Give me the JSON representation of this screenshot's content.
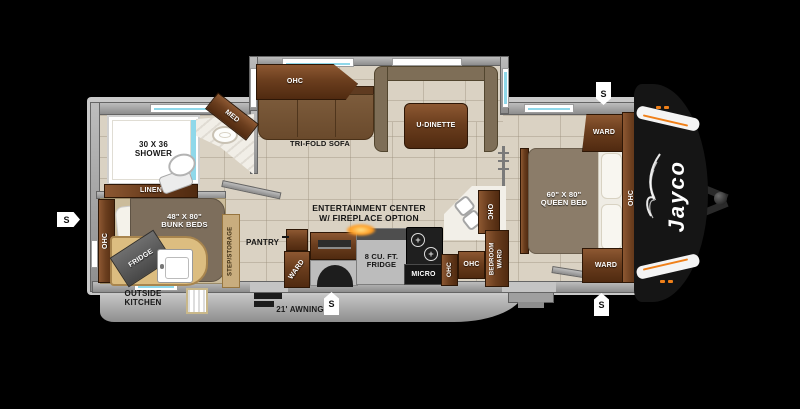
{
  "brand_logo": "Jayco",
  "labels": {
    "awning": "21' AWNING",
    "speaker": "S",
    "shower_line1": "30 X 36",
    "shower_line2": "SHOWER",
    "linen": "LINEN",
    "med": "MED",
    "ohc": "OHC",
    "trifold_sofa": "TRI-FOLD SOFA",
    "udinette": "U-DINETTE",
    "bunk_line1": "48\" X 80\"",
    "bunk_line2": "BUNK BEDS",
    "fridge_outside": "FRIDGE",
    "outside_line1": "OUTSIDE",
    "outside_line2": "KITCHEN",
    "step_storage": "STEP/STORAGE",
    "ent_line1": "ENTERTAINMENT CENTER",
    "ent_line2": "W/ FIREPLACE OPTION",
    "pantry": "PANTRY",
    "ward": "WARD",
    "fridge8_line1": "8 CU. FT.",
    "fridge8_line2": "FRIDGE",
    "micro": "MICRO",
    "bedroom_ward": "BEDROOM WARD",
    "queen_line1": "60\" X 80\"",
    "queen_line2": "QUEEN BED"
  },
  "colors": {
    "accent_orange": "#f08019",
    "window_blue": "#8fd8ea",
    "wall_gray": "#9a9a9a",
    "floor_tan": "#dad2c3",
    "cabinet_wood": "#6b3e1e",
    "front_cap": "#151515"
  }
}
